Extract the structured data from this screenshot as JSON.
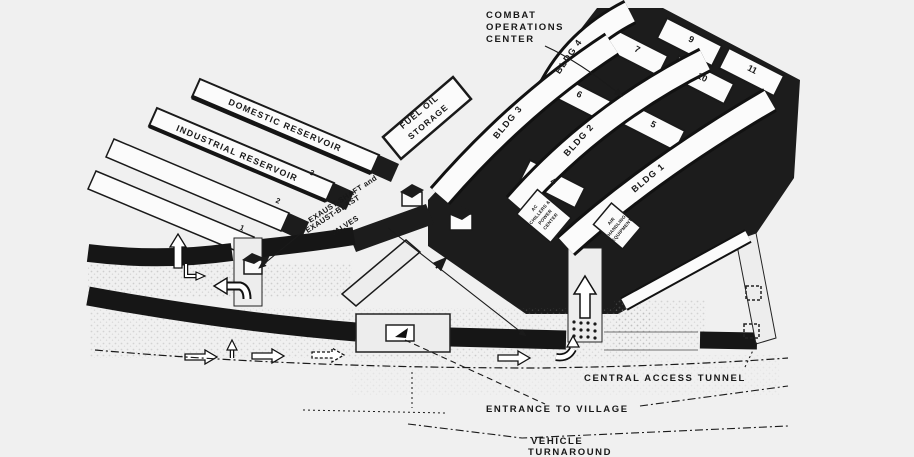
{
  "colors": {
    "background": "#f0f0f0",
    "ink": "#1a1a1a",
    "paper": "#fbfbfb",
    "road_fill": "#ededed"
  },
  "labels": {
    "combat_ops_line1": "COMBAT",
    "combat_ops_line2": "OPERATIONS",
    "combat_ops_line3": "CENTER",
    "domestic_reservoir": "DOMESTIC RESERVOIR",
    "industrial_reservoir": "INDUSTRIAL RESERVOIR",
    "fuel_oil_line1": "FUEL OIL",
    "fuel_oil_line2": "STORAGE",
    "exhaust_line1": "EXAUST-SHAFT and",
    "exhaust_line2": "EXAUST-BLAST",
    "exhaust_line3": "VALVES",
    "central_access_tunnel": "CENTRAL ACCESS TUNNEL",
    "entrance_to_village": "ENTRANCE TO VILLAGE",
    "vehicle_turnaround_line1": "VEHICLE",
    "vehicle_turnaround_line2": "TURNAROUND",
    "ac_chillers_line1": "AC",
    "ac_chillers_line2": "CHILLERS &",
    "ac_chillers_line3": "POWER",
    "ac_chillers_line4": "CENTER",
    "air_handling_line1": "AIR",
    "air_handling_line2": "HANDLING",
    "air_handling_line3": "EQUIPMENT"
  },
  "buildings": {
    "bldg_1": "BLDG 1",
    "bldg_2": "BLDG 2",
    "bldg_3": "BLDG 3",
    "bldg_4": "BLDG 4",
    "num_1": "1",
    "num_2": "2",
    "num_3": "3",
    "num_4": "4",
    "num_5": "5",
    "num_6": "6",
    "num_7": "7",
    "num_9": "9",
    "num_10": "10",
    "num_11": "11"
  }
}
